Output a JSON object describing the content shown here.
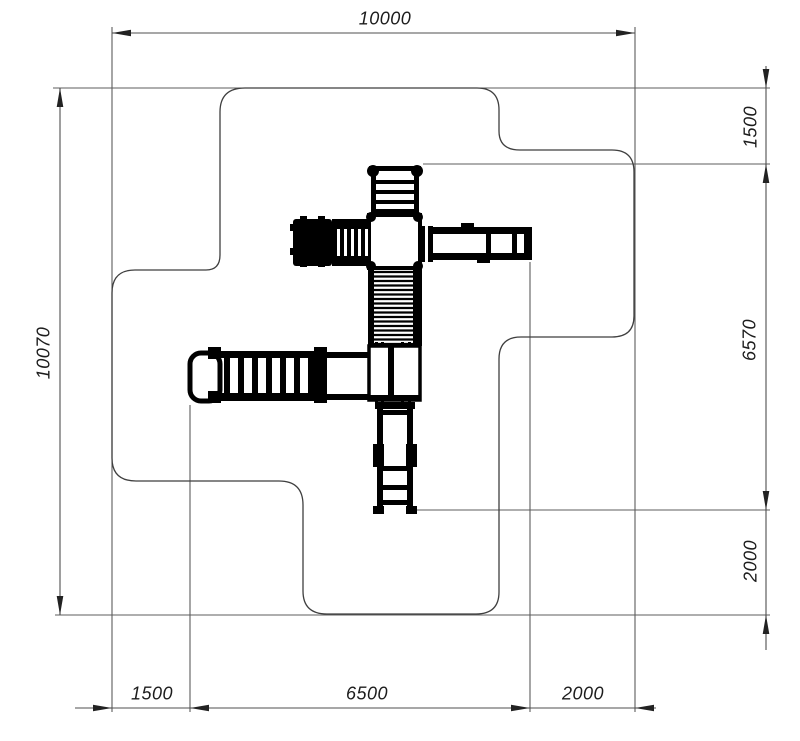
{
  "drawing": {
    "type": "playground-equipment-safety-zone-plan",
    "background_color": "#ffffff",
    "thin_line_color": "#4a4a4a",
    "equipment_color": "#000000",
    "text_color": "#1c1c1c",
    "dimensions": {
      "top": [
        {
          "label": "10000"
        }
      ],
      "left": [
        {
          "label": "10070"
        }
      ],
      "right": [
        {
          "label": "1500"
        },
        {
          "label": "6570"
        },
        {
          "label": "2000"
        }
      ],
      "bottom": [
        {
          "label": "1500"
        },
        {
          "label": "6500"
        },
        {
          "label": "2000"
        }
      ]
    }
  }
}
